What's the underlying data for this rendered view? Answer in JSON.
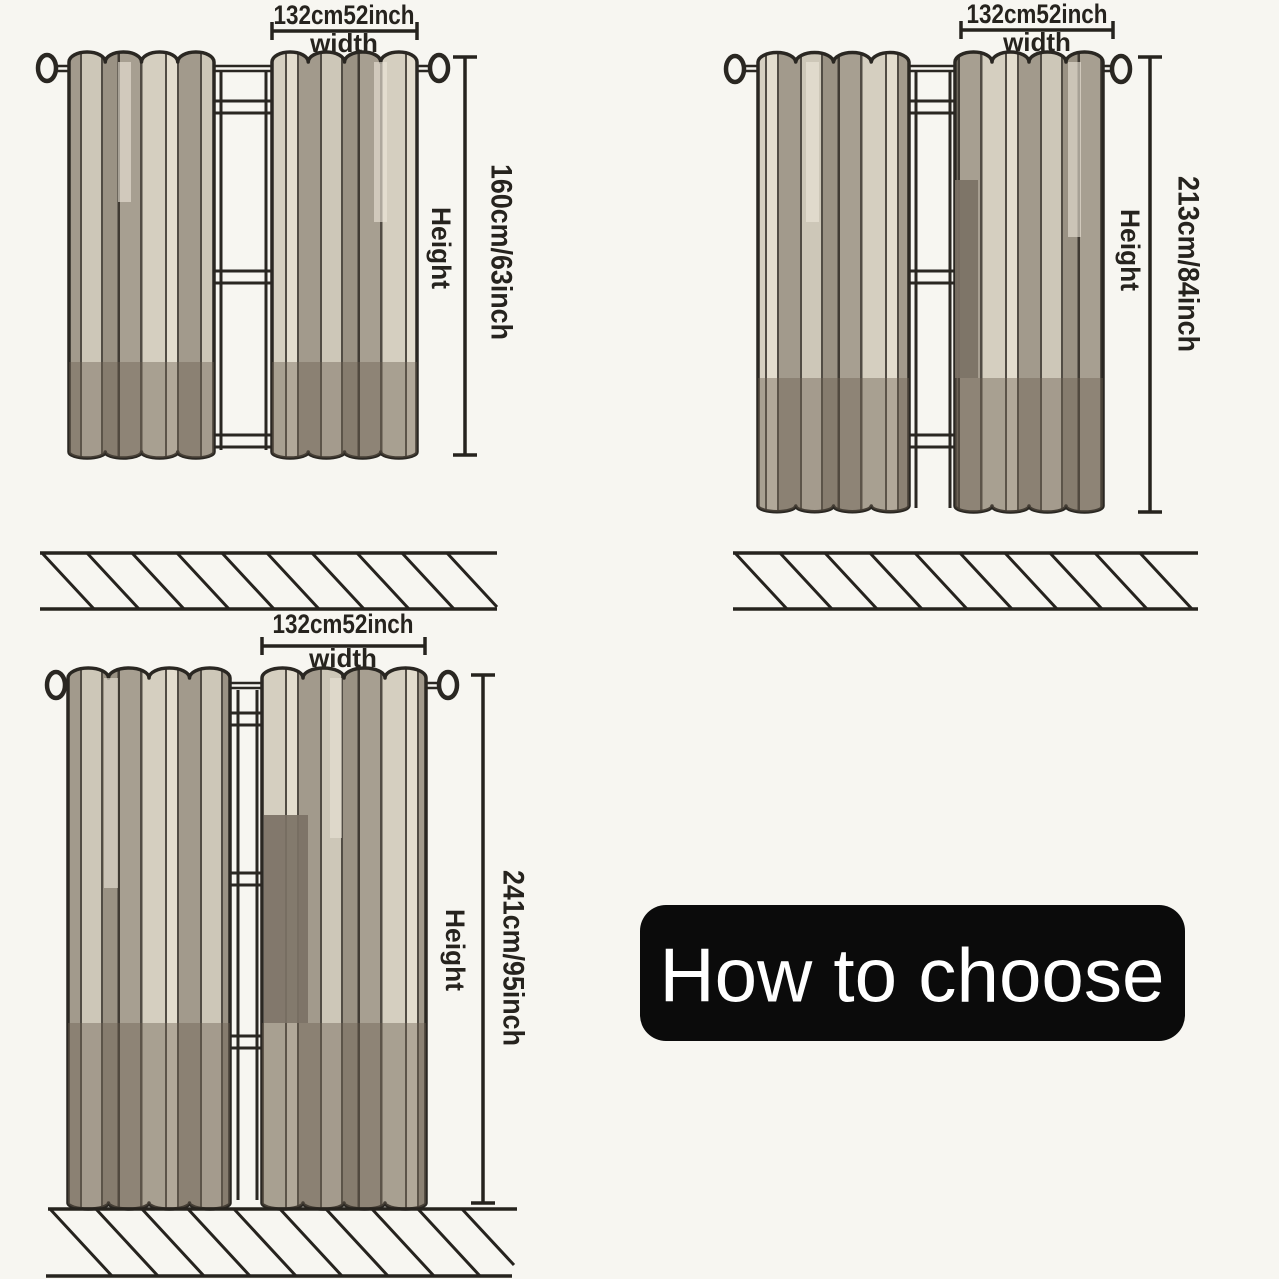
{
  "banner": {
    "label": "How to choose",
    "background": "#0b0b0b",
    "text_color": "#ffffff"
  },
  "diagrams": [
    {
      "id": "curtain-height-63inch",
      "width_value": "132cm52inch",
      "width_word": "width",
      "height_word": "Height",
      "height_value": "160cm/63inch"
    },
    {
      "id": "curtain-height-84inch",
      "width_value": "132cm52inch",
      "width_word": "width",
      "height_word": "Height",
      "height_value": "213cm/84inch"
    },
    {
      "id": "curtain-height-95inch",
      "width_value": "132cm52inch",
      "width_word": "width",
      "height_word": "Height",
      "height_value": "241cm/95inch"
    }
  ],
  "colors": {
    "background": "#f7f6f1",
    "outline": "#2a2722",
    "text": "#26231e",
    "fabric_taupe": "#a79f91",
    "fabric_cream": "#d5cfc0",
    "fabric_highlight": "#e3ddce",
    "fabric_light_gray": "#cdc7b8",
    "fabric_dark_stripe": "#7b7165",
    "bottom_band_tint": "rgba(107,95,82,0.42)",
    "banner_bg": "#0b0b0b"
  }
}
